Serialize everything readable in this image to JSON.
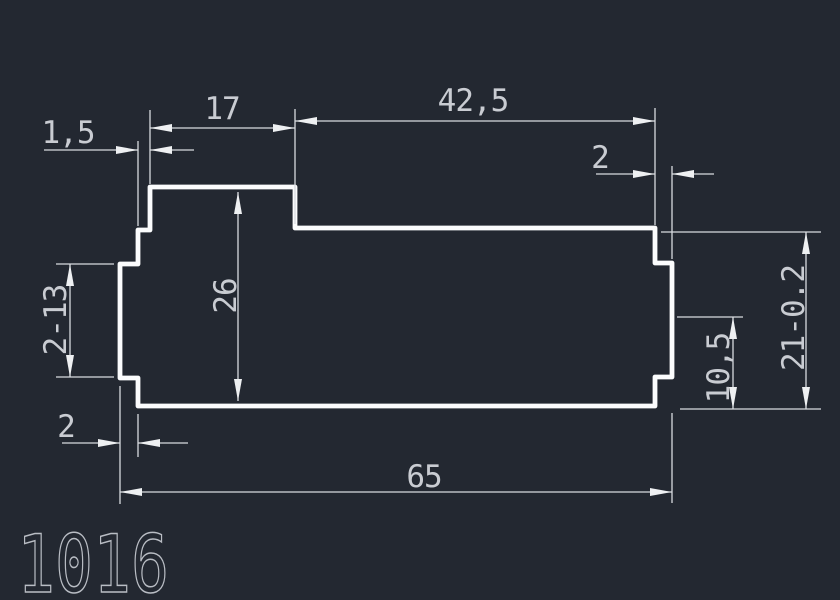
{
  "colors": {
    "background": "#232831",
    "profile_line": "#fbfcfd",
    "dimension_line": "#d8dbe0",
    "dimension_text": "#c9ccd2",
    "part_number_text": "#b9bdc4"
  },
  "part_number": "1016",
  "dimensions": {
    "raised_top_width": "17",
    "top_right_width": "42,5",
    "left_top_step": "1,5",
    "right_notch_depth": "2",
    "inner_height": "26",
    "side_notch_height": "2-13",
    "right_height_with_tolerance": "21-0.2",
    "right_lower_height": "10,5",
    "left_notch_depth": "2",
    "overall_width": "65"
  }
}
